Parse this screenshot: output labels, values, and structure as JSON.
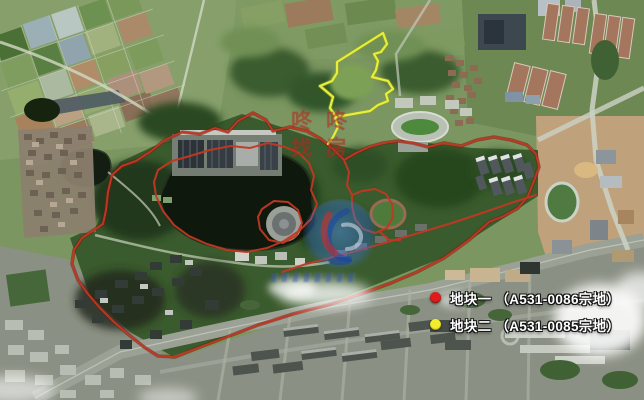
{
  "map": {
    "kind": "satellite-imagery-with-parcel-outlines",
    "language": "zh-CN"
  },
  "legend": {
    "items": [
      {
        "id": "parcel-1",
        "marker_color": "#e01c1a",
        "label": "地块一 （A531-0086宗地）"
      },
      {
        "id": "parcel-2",
        "marker_color": "#f2ee2e",
        "label": "地块二 （A531-0085宗地）"
      }
    ]
  },
  "boundaries": {
    "parcel_1_outline_color": "#c23822",
    "parcel_2_outline_color": "#e6ee3e"
  },
  "watermarks": {
    "center_line1": "咚咚",
    "center_line2": "找房",
    "center_color": "#ba2c26"
  }
}
